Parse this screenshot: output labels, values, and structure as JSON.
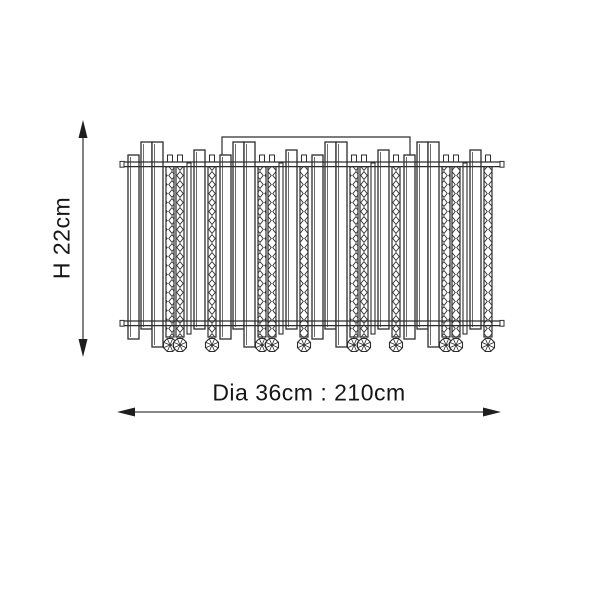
{
  "drawing": {
    "height_label": "H 22cm",
    "width_label": "Dia 36cm : 210cm",
    "line_color": "#2d2d2d",
    "dimension_color": "#3f3f3f",
    "arrow_color": "#1e1e1e",
    "text_color": "#161616",
    "background": "#ffffff",
    "fixture": {
      "left": 128,
      "module_width": 92,
      "modules": 4,
      "top_rail_y": 162,
      "bottom_rail_y": 321,
      "rail_thickness": 4.6,
      "bracket": {
        "left": 222,
        "right": 410,
        "top": 137
      },
      "crystal_bottom": 337,
      "bead_radius": 7,
      "bars": [
        {
          "dx": 0,
          "w": 11,
          "type": "plain",
          "top": 155,
          "bottom": 339
        },
        {
          "dx": 13,
          "w": 11,
          "type": "plain",
          "top": 142,
          "bottom": 329
        },
        {
          "dx": 24,
          "w": 11,
          "type": "plain",
          "top": 142,
          "bottom": 347
        },
        {
          "dx": 38,
          "w": 8,
          "type": "crystal"
        },
        {
          "dx": 48,
          "w": 8,
          "type": "crystal"
        },
        {
          "dx": 59,
          "w": 4,
          "type": "rod",
          "bottom": 334
        },
        {
          "dx": 66,
          "w": 11,
          "type": "plain",
          "top": 150,
          "bottom": 329
        },
        {
          "dx": 80,
          "w": 8,
          "type": "crystal"
        }
      ]
    },
    "dimensions": {
      "vertical": {
        "x": 83,
        "y1": 120,
        "y2": 357
      },
      "horizontal": {
        "y": 412,
        "x1": 117,
        "x2": 501
      }
    }
  }
}
